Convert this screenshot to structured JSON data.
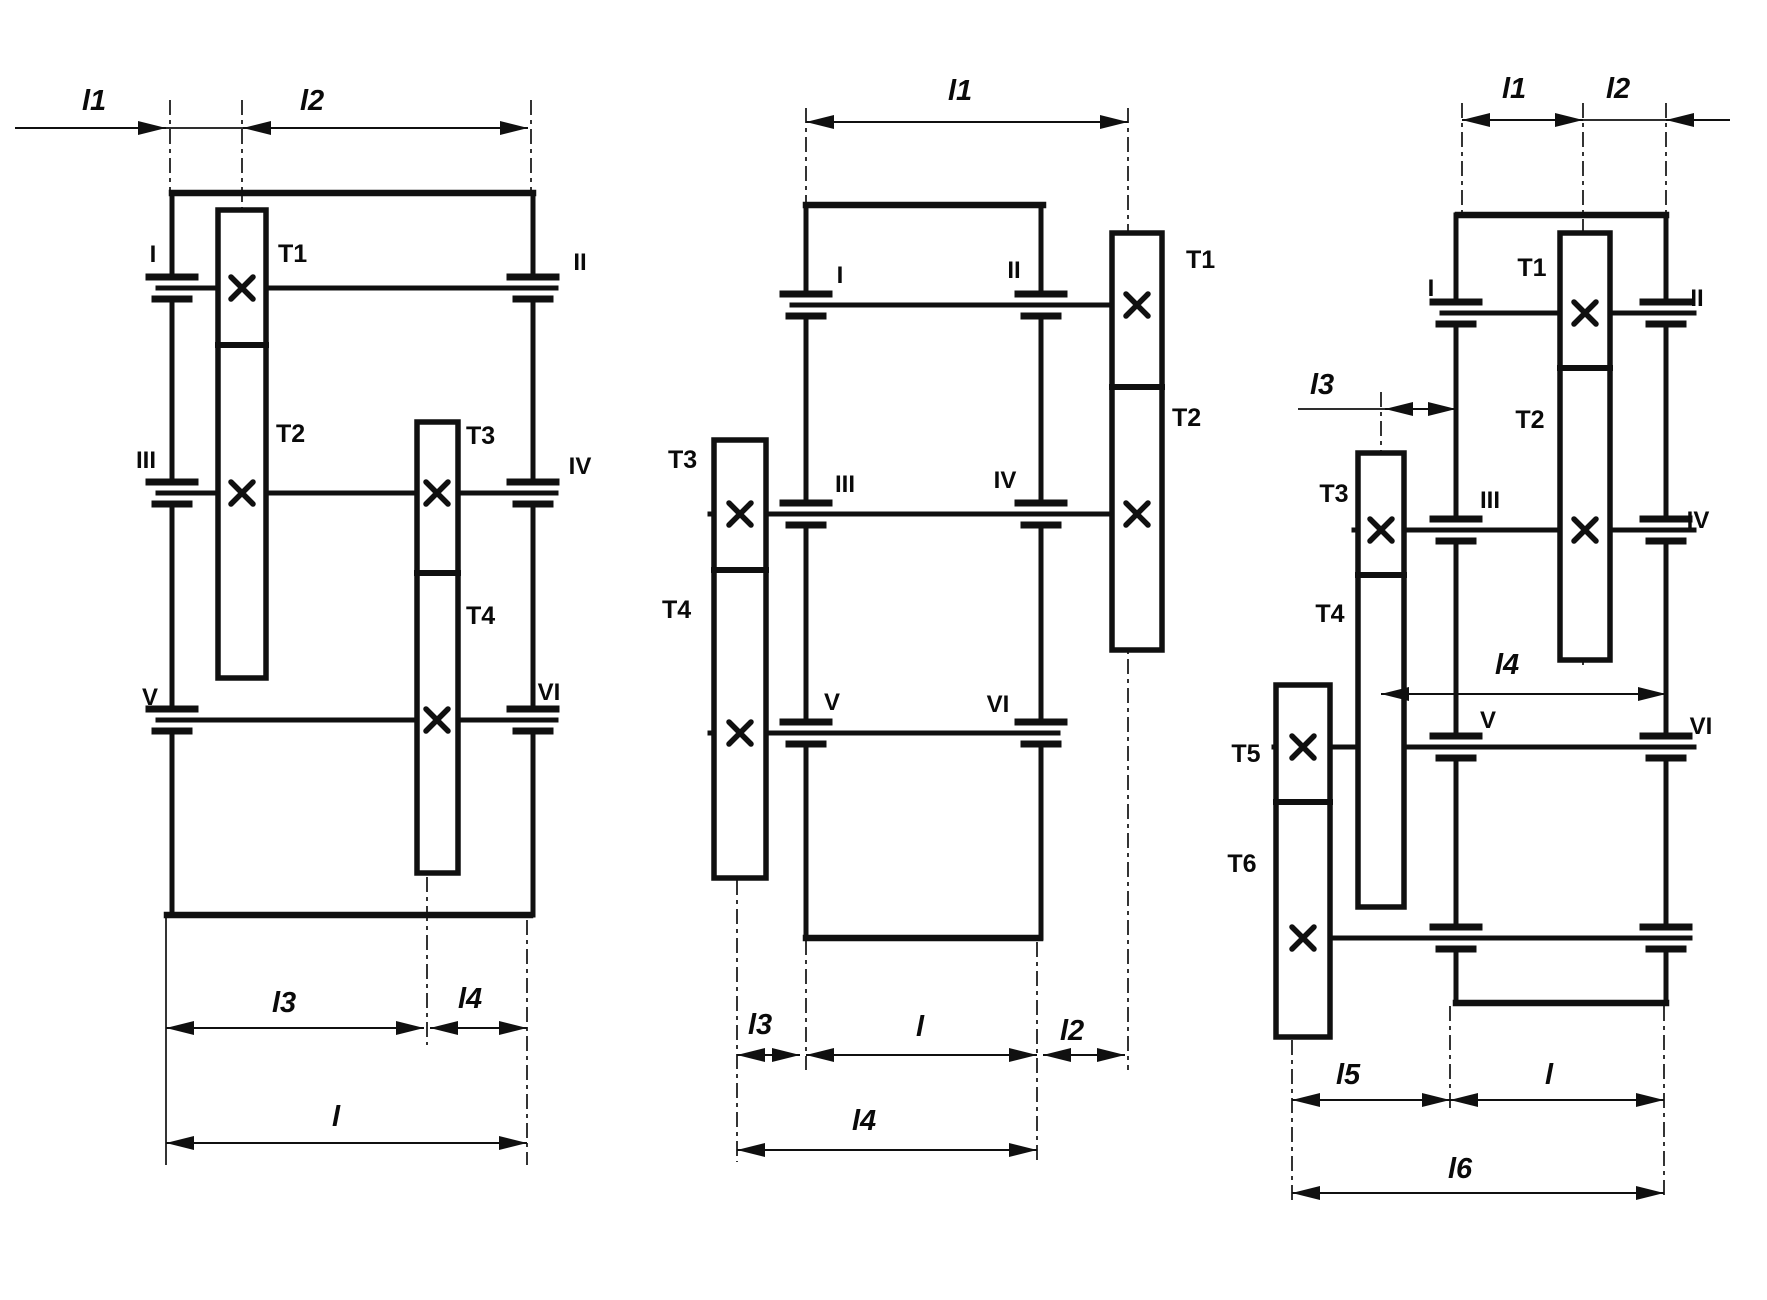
{
  "figure": {
    "description": "Three kinematic scheme variants of a three-stage gear drive with dimension chains",
    "background_color": "#ffffff",
    "ink_color": "#101010"
  },
  "diagrams": [
    {
      "name": "variant-1",
      "dims": {
        "l1": "l1",
        "l2": "l2",
        "l3": "l3",
        "l4": "l4",
        "l": "l"
      },
      "shafts": {
        "i": "I",
        "ii": "II",
        "iii": "III",
        "iv": "IV",
        "v": "V",
        "vi": "VI"
      },
      "gears": {
        "t1": "T1",
        "t2": "T2",
        "t3": "T3",
        "t4": "T4"
      }
    },
    {
      "name": "variant-2",
      "dims": {
        "l1": "l1",
        "l2": "l2",
        "l3": "l3",
        "l4": "l4",
        "l": "l"
      },
      "shafts": {
        "i": "I",
        "ii": "II",
        "iii": "III",
        "iv": "IV",
        "v": "V",
        "vi": "VI"
      },
      "gears": {
        "t1": "T1",
        "t2": "T2",
        "t3": "T3",
        "t4": "T4"
      }
    },
    {
      "name": "variant-3",
      "dims": {
        "l1": "l1",
        "l2": "l2",
        "l3": "l3",
        "l4": "l4",
        "l5": "l5",
        "l6": "l6",
        "l": "l"
      },
      "shafts": {
        "i": "I",
        "ii": "II",
        "iii": "III",
        "iv": "IV",
        "v": "V",
        "vi": "VI"
      },
      "gears": {
        "t1": "T1",
        "t2": "T2",
        "t3": "T3",
        "t4": "T4",
        "t5": "T5",
        "t6": "T6"
      }
    }
  ]
}
